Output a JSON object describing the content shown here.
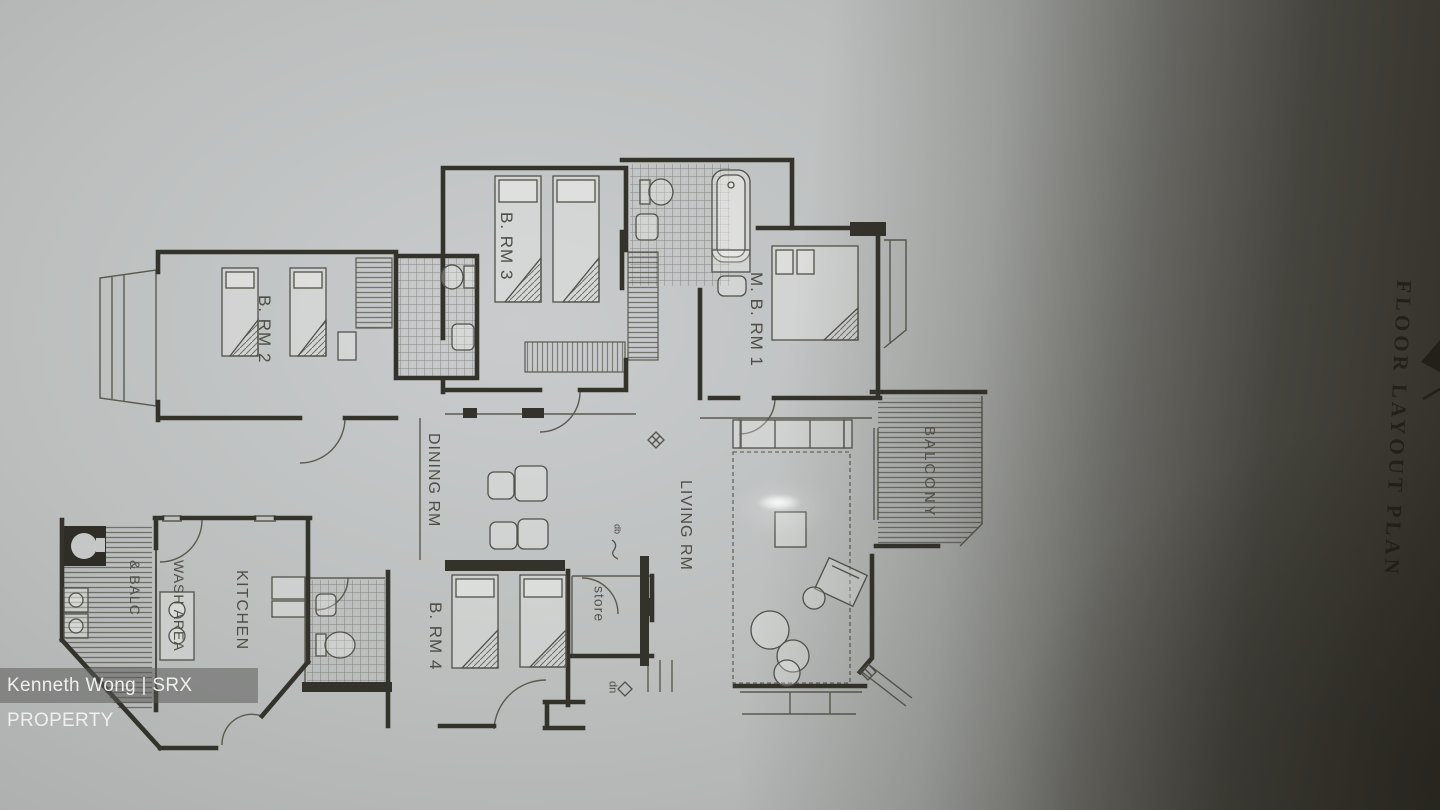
{
  "photo": {
    "watermark": "Kenneth Wong | SRX PROPERTY",
    "side_title": "FLOOR LAYOUT PLAN",
    "colors": {
      "paper": "#b5b8b7",
      "paper_highlight": "#c9cbcd",
      "shadow": "#36332a",
      "wall_ink": "#34332b",
      "label_ink": "#4e4d46",
      "watermark_text": "#f0efed"
    }
  },
  "plan": {
    "labels": {
      "bedroom2": "B. RM 2",
      "bedroom3": "B. RM 3",
      "bedroom4": "B. RM 4",
      "master_bedroom": "M. B. RM 1",
      "dining": "DINING RM",
      "living": "LIVING RM",
      "kitchen": "KITCHEN",
      "wash_line1": "WASH AREA",
      "wash_line2": "& BALC",
      "store": "store",
      "balcony": "BALCONY",
      "down": "dn",
      "db": "db"
    },
    "symbols": [
      "diamond-symbol",
      "entry-steps",
      "door-swing-arc"
    ]
  }
}
